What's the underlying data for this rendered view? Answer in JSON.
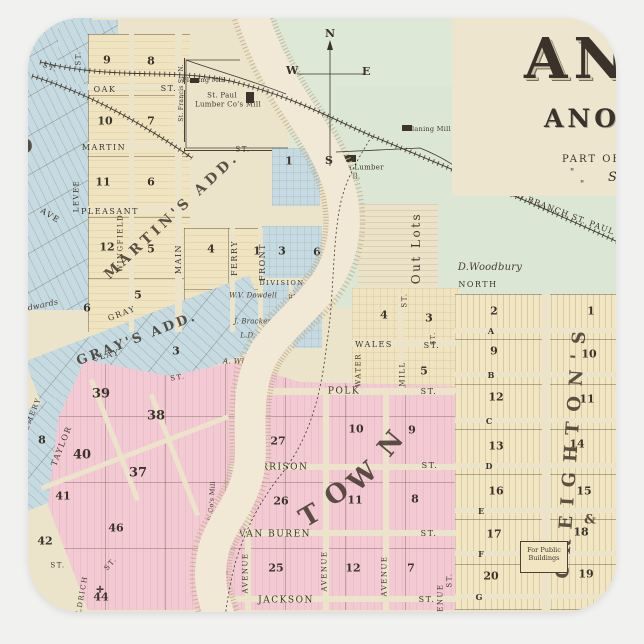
{
  "product": {
    "background_color": "#f1f1f0",
    "sticker_shape": "rounded-square"
  },
  "colors": {
    "paper": "#ece3cb",
    "title_paper": "#eee5cf",
    "green_land": "#dee8d7",
    "blue_blocks": "#c5dae1",
    "yellow_blocks": "#efe4bf",
    "creighton_yellow": "#f1e6c1",
    "pink_blocks": "#f3c9d3",
    "river_water": "#f1e9d6",
    "river_bank": "#c2ae8c",
    "ink": "#3f362b"
  },
  "title": {
    "masthead_partial": "AN",
    "county_line": "ANOKA CO",
    "state_initial": "M",
    "subtitle": "PART OF SEC",
    "ditto_row1": "\" \" \"",
    "ditto_row2": "\" \"",
    "scale_label": "Scale"
  },
  "compass": {
    "n": "N",
    "w": "W",
    "e": "E",
    "s": "S"
  },
  "railroad": {
    "label": "ST. CLOUD BRANCH ST. PAUL &"
  },
  "public_buildings": {
    "line1": "For Public",
    "line2": "Buildings"
  },
  "regions": [
    {
      "name": "open-land-north",
      "x": 268,
      "y": 18,
      "w": 348,
      "h": 132,
      "c": "#dee8d7"
    },
    {
      "name": "open-land-east",
      "x": 336,
      "y": 86,
      "w": 280,
      "h": 222,
      "c": "#dbe6d4"
    },
    {
      "name": "blue-addition-northwest",
      "x": 28,
      "y": 18,
      "w": 64,
      "h": 292,
      "c": "#c5dae1",
      "g": "gdiag"
    },
    {
      "name": "blue-addition-northwest-2",
      "x": 58,
      "y": 20,
      "w": 60,
      "h": 64,
      "c": "#c5dae1",
      "g": "gdiag"
    },
    {
      "name": "martins-add-grid",
      "x": 88,
      "y": 34,
      "w": 102,
      "h": 298,
      "c": "#efe4bf",
      "g": "gym"
    },
    {
      "name": "martins-add-grid-east",
      "x": 184,
      "y": 228,
      "w": 106,
      "h": 104,
      "c": "#efe4bf",
      "g": "gym"
    },
    {
      "name": "lumber-yard",
      "x": 184,
      "y": 58,
      "w": 104,
      "h": 92,
      "c": "#ece3cb",
      "cls": "yard"
    },
    {
      "name": "blue-block-river",
      "x": 272,
      "y": 148,
      "w": 48,
      "h": 58,
      "c": "#c5dae1",
      "g": "ghv"
    },
    {
      "name": "division-st-blocks",
      "x": 262,
      "y": 226,
      "w": 60,
      "h": 122,
      "c": "#c5dae1",
      "g": "ghv"
    },
    {
      "name": "out-lots",
      "x": 358,
      "y": 204,
      "w": 80,
      "h": 98,
      "c": "#ebe2c8",
      "g": "gh"
    },
    {
      "name": "wales-st-blocks",
      "x": 352,
      "y": 288,
      "w": 108,
      "h": 112,
      "c": "#efe4bf",
      "g": "ghv"
    },
    {
      "name": "grays-add-band",
      "x": 30,
      "y": 316,
      "w": 240,
      "h": 72,
      "c": "#c5dae1",
      "g": "gdiag",
      "r": -21,
      "ox": 150,
      "oy": 352
    },
    {
      "name": "grays-add-band-south",
      "x": -5,
      "y": 400,
      "w": 130,
      "h": 95,
      "c": "#c5dae1",
      "g": "gdiag",
      "r": -21,
      "ox": 60,
      "oy": 448
    },
    {
      "name": "creightons-add-grid",
      "x": 455,
      "y": 294,
      "w": 161,
      "h": 316,
      "c": "#f1e6c1",
      "g": "grows"
    },
    {
      "name": "town-pink-area",
      "x": 45,
      "y": 350,
      "w": 412,
      "h": 260,
      "c": "#f3c9d3",
      "g": "gpink",
      "cls": "pink-clip"
    }
  ],
  "street_gaps": [
    {
      "x": 88,
      "y": 84,
      "w": 104,
      "h": 6
    },
    {
      "x": 88,
      "y": 142,
      "w": 104,
      "h": 6
    },
    {
      "x": 88,
      "y": 206,
      "w": 104,
      "h": 6
    },
    {
      "x": 129,
      "y": 34,
      "w": 5,
      "h": 298
    },
    {
      "x": 175,
      "y": 34,
      "w": 7,
      "h": 298
    },
    {
      "x": 230,
      "y": 228,
      "w": 5,
      "h": 104
    },
    {
      "x": 258,
      "y": 228,
      "w": 5,
      "h": 104
    },
    {
      "x": 262,
      "y": 278,
      "w": 60,
      "h": 5
    },
    {
      "x": 289,
      "y": 280,
      "w": 4,
      "h": 68
    },
    {
      "x": 352,
      "y": 340,
      "w": 108,
      "h": 6
    },
    {
      "x": 352,
      "y": 388,
      "w": 108,
      "h": 5
    },
    {
      "x": 398,
      "y": 294,
      "w": 5,
      "h": 46
    },
    {
      "x": 399,
      "y": 346,
      "w": 4,
      "h": 42
    },
    {
      "x": 542,
      "y": 294,
      "w": 8,
      "h": 316
    },
    {
      "x": 455,
      "y": 328,
      "w": 161,
      "h": 5
    },
    {
      "x": 455,
      "y": 372,
      "w": 161,
      "h": 5
    },
    {
      "x": 455,
      "y": 418,
      "w": 161,
      "h": 5
    },
    {
      "x": 455,
      "y": 463,
      "w": 161,
      "h": 5
    },
    {
      "x": 455,
      "y": 508,
      "w": 161,
      "h": 5
    },
    {
      "x": 455,
      "y": 551,
      "w": 161,
      "h": 5
    },
    {
      "x": 455,
      "y": 594,
      "w": 161,
      "h": 5
    },
    {
      "x": 235,
      "y": 388,
      "w": 220,
      "h": 7
    },
    {
      "x": 230,
      "y": 464,
      "w": 226,
      "h": 6
    },
    {
      "x": 230,
      "y": 530,
      "w": 226,
      "h": 6
    },
    {
      "x": 230,
      "y": 596,
      "w": 226,
      "h": 6
    },
    {
      "x": 245,
      "y": 464,
      "w": 6,
      "h": 146
    },
    {
      "x": 323,
      "y": 388,
      "w": 6,
      "h": 222
    },
    {
      "x": 383,
      "y": 388,
      "w": 6,
      "h": 222
    },
    {
      "x": 35,
      "y": 450,
      "w": 200,
      "h": 5,
      "r": -21,
      "ox": 135,
      "oy": 452
    },
    {
      "x": 112,
      "y": 375,
      "w": 5,
      "h": 130,
      "r": -21,
      "ox": 115,
      "oy": 415
    },
    {
      "x": 172,
      "y": 390,
      "w": 5,
      "h": 130,
      "r": -21,
      "ox": 175,
      "oy": 455
    }
  ],
  "map_labels": [
    {
      "t": "OAK",
      "x": 105,
      "y": 90,
      "c": "st"
    },
    {
      "t": "ST.",
      "x": 169,
      "y": 89,
      "c": "st"
    },
    {
      "t": "MARTIN",
      "x": 104,
      "y": 148,
      "c": "st"
    },
    {
      "t": "PLEASANT",
      "x": 110,
      "y": 212,
      "c": "st"
    },
    {
      "t": "GRAY",
      "x": 122,
      "y": 314,
      "r": -21,
      "c": "st"
    },
    {
      "t": "CLAY",
      "x": 106,
      "y": 356,
      "r": -14,
      "c": "st"
    },
    {
      "t": "ST.",
      "x": 178,
      "y": 378,
      "r": -10,
      "c": "st",
      "s": 7
    },
    {
      "t": "DIVISION",
      "x": 282,
      "y": 283,
      "c": "st",
      "s": 6.5
    },
    {
      "t": "ST.",
      "x": 314,
      "y": 284,
      "c": "st",
      "s": 6.5
    },
    {
      "t": "WALES",
      "x": 374,
      "y": 345,
      "c": "st"
    },
    {
      "t": "ST.",
      "x": 432,
      "y": 346,
      "c": "st"
    },
    {
      "t": "POLK",
      "x": 344,
      "y": 392,
      "c": "st",
      "s": 9
    },
    {
      "t": "ST.",
      "x": 429,
      "y": 392,
      "c": "st"
    },
    {
      "t": "HARRISON",
      "x": 276,
      "y": 468,
      "c": "st",
      "s": 9
    },
    {
      "t": "ST.",
      "x": 430,
      "y": 466,
      "c": "st"
    },
    {
      "t": "VAN BUREN",
      "x": 275,
      "y": 535,
      "c": "st",
      "s": 9
    },
    {
      "t": "ST.",
      "x": 429,
      "y": 534,
      "c": "st"
    },
    {
      "t": "JACKSON",
      "x": 286,
      "y": 601,
      "c": "st",
      "s": 9
    },
    {
      "t": "ST.",
      "x": 427,
      "y": 600,
      "c": "st"
    },
    {
      "t": "ST.",
      "x": 58,
      "y": 566,
      "c": "st",
      "s": 7
    },
    {
      "t": "ST.",
      "x": 111,
      "y": 564,
      "r": -50,
      "c": "st",
      "s": 7
    },
    {
      "t": "ST.",
      "x": 243,
      "y": 150,
      "c": "st",
      "s": 7
    },
    {
      "t": "ST.",
      "x": 50,
      "y": 68,
      "r": 22,
      "c": "st",
      "s": 7
    },
    {
      "t": "LEVEE",
      "x": 77,
      "y": 196,
      "r": -90,
      "c": "st",
      "s": 7
    },
    {
      "t": "WINGFIELD",
      "x": 121,
      "y": 243,
      "r": -90,
      "c": "st",
      "s": 7
    },
    {
      "t": "MAIN",
      "x": 179,
      "y": 259,
      "r": -90,
      "c": "st"
    },
    {
      "t": "FERRY",
      "x": 235,
      "y": 258,
      "r": -90,
      "c": "st"
    },
    {
      "t": "FRONT",
      "x": 263,
      "y": 262,
      "r": -90,
      "c": "st"
    },
    {
      "t": "MAPLE",
      "x": 293,
      "y": 311,
      "r": -90,
      "c": "st"
    },
    {
      "t": "St. Francis St. N.",
      "x": 182,
      "y": 93,
      "r": -90,
      "c": "lbl",
      "s": 6
    },
    {
      "t": "ST.",
      "x": 79,
      "y": 58,
      "r": -90,
      "c": "st",
      "s": 7
    },
    {
      "t": "ST.",
      "x": 405,
      "y": 300,
      "r": -90,
      "c": "st",
      "s": 7
    },
    {
      "t": "MILL",
      "x": 403,
      "y": 374,
      "r": -90,
      "c": "st",
      "s": 7
    },
    {
      "t": "WATER",
      "x": 359,
      "y": 370,
      "r": -90,
      "c": "st",
      "s": 7
    },
    {
      "t": "AVENUE",
      "x": 246,
      "y": 573,
      "r": -90,
      "c": "st",
      "s": 7
    },
    {
      "t": "AVENUE",
      "x": 325,
      "y": 571,
      "r": -90,
      "c": "st",
      "s": 7
    },
    {
      "t": "AVENUE",
      "x": 385,
      "y": 576,
      "r": -90,
      "c": "st",
      "s": 7
    },
    {
      "t": "AVENUE",
      "x": 441,
      "y": 604,
      "r": -90,
      "c": "st",
      "s": 7
    },
    {
      "t": "TAYLOR",
      "x": 62,
      "y": 446,
      "r": -68,
      "c": "st"
    },
    {
      "t": "EMERY",
      "x": 33,
      "y": 414,
      "r": -68,
      "c": "st",
      "s": 7
    },
    {
      "t": "ALDRICH",
      "x": 82,
      "y": 598,
      "r": -80,
      "c": "st",
      "s": 7
    },
    {
      "t": "ST.",
      "x": 450,
      "y": 580,
      "r": -90,
      "c": "st",
      "s": 7
    },
    {
      "t": "ST.",
      "x": 434,
      "y": 338,
      "r": -90,
      "c": "st",
      "s": 6
    },
    {
      "t": "AVE",
      "x": 50,
      "y": 216,
      "r": 32,
      "c": "st"
    },
    {
      "t": "A",
      "x": 491,
      "y": 331,
      "c": "num",
      "s": 8
    },
    {
      "t": "B",
      "x": 491,
      "y": 375,
      "c": "num",
      "s": 8
    },
    {
      "t": "C",
      "x": 489,
      "y": 421,
      "c": "num",
      "s": 8
    },
    {
      "t": "D",
      "x": 489,
      "y": 466,
      "c": "num",
      "s": 8
    },
    {
      "t": "E",
      "x": 481,
      "y": 511,
      "c": "num",
      "s": 8
    },
    {
      "t": "F",
      "x": 481,
      "y": 554,
      "c": "num",
      "s": 8
    },
    {
      "t": "G",
      "x": 479,
      "y": 597,
      "c": "num",
      "s": 8
    },
    {
      "t": "9",
      "x": 107,
      "y": 60,
      "c": "num"
    },
    {
      "t": "8",
      "x": 151,
      "y": 61,
      "c": "num"
    },
    {
      "t": "10",
      "x": 105,
      "y": 121,
      "c": "num"
    },
    {
      "t": "7",
      "x": 151,
      "y": 121,
      "c": "num"
    },
    {
      "t": "11",
      "x": 103,
      "y": 182,
      "c": "num"
    },
    {
      "t": "6",
      "x": 151,
      "y": 182,
      "c": "num"
    },
    {
      "t": "12",
      "x": 107,
      "y": 247,
      "c": "num"
    },
    {
      "t": "5",
      "x": 151,
      "y": 249,
      "c": "num"
    },
    {
      "t": "4",
      "x": 211,
      "y": 249,
      "c": "num"
    },
    {
      "t": "1",
      "x": 257,
      "y": 251,
      "c": "num"
    },
    {
      "t": "3",
      "x": 282,
      "y": 251,
      "c": "num"
    },
    {
      "t": "6",
      "x": 317,
      "y": 252,
      "c": "num"
    },
    {
      "t": "4",
      "x": 287,
      "y": 309,
      "c": "num"
    },
    {
      "t": "5",
      "x": 314,
      "y": 307,
      "c": "num"
    },
    {
      "t": "1",
      "x": 289,
      "y": 161,
      "c": "num"
    },
    {
      "t": "4",
      "x": 384,
      "y": 315,
      "c": "num"
    },
    {
      "t": "3",
      "x": 429,
      "y": 318,
      "c": "num"
    },
    {
      "t": "5",
      "x": 424,
      "y": 371,
      "c": "num"
    },
    {
      "t": "2",
      "x": 494,
      "y": 311,
      "c": "num"
    },
    {
      "t": "1",
      "x": 591,
      "y": 311,
      "c": "num"
    },
    {
      "t": "9",
      "x": 494,
      "y": 351,
      "c": "num"
    },
    {
      "t": "10",
      "x": 589,
      "y": 354,
      "c": "num"
    },
    {
      "t": "12",
      "x": 496,
      "y": 397,
      "c": "num"
    },
    {
      "t": "11",
      "x": 587,
      "y": 399,
      "c": "num"
    },
    {
      "t": "13",
      "x": 496,
      "y": 446,
      "c": "num"
    },
    {
      "t": "14",
      "x": 577,
      "y": 444,
      "c": "num"
    },
    {
      "t": "16",
      "x": 496,
      "y": 491,
      "c": "num"
    },
    {
      "t": "15",
      "x": 584,
      "y": 491,
      "c": "num"
    },
    {
      "t": "17",
      "x": 494,
      "y": 534,
      "c": "num"
    },
    {
      "t": "18",
      "x": 581,
      "y": 532,
      "c": "num"
    },
    {
      "t": "20",
      "x": 491,
      "y": 576,
      "c": "num"
    },
    {
      "t": "19",
      "x": 586,
      "y": 574,
      "c": "num"
    },
    {
      "t": "39",
      "x": 101,
      "y": 394,
      "c": "num",
      "s": 13
    },
    {
      "t": "38",
      "x": 156,
      "y": 416,
      "c": "num",
      "s": 13
    },
    {
      "t": "40",
      "x": 82,
      "y": 455,
      "c": "num",
      "s": 13
    },
    {
      "t": "37",
      "x": 138,
      "y": 473,
      "c": "num",
      "s": 13
    },
    {
      "t": "27",
      "x": 278,
      "y": 441,
      "c": "num"
    },
    {
      "t": "10",
      "x": 356,
      "y": 429,
      "c": "num"
    },
    {
      "t": "9",
      "x": 412,
      "y": 430,
      "c": "num"
    },
    {
      "t": "26",
      "x": 281,
      "y": 501,
      "c": "num"
    },
    {
      "t": "11",
      "x": 355,
      "y": 500,
      "c": "num"
    },
    {
      "t": "8",
      "x": 415,
      "y": 499,
      "c": "num"
    },
    {
      "t": "25",
      "x": 276,
      "y": 568,
      "c": "num"
    },
    {
      "t": "12",
      "x": 353,
      "y": 568,
      "c": "num"
    },
    {
      "t": "7",
      "x": 411,
      "y": 568,
      "c": "num"
    },
    {
      "t": "41",
      "x": 63,
      "y": 496,
      "c": "num"
    },
    {
      "t": "42",
      "x": 45,
      "y": 541,
      "c": "num"
    },
    {
      "t": "46",
      "x": 116,
      "y": 528,
      "c": "num"
    },
    {
      "t": "44",
      "x": 101,
      "y": 597,
      "c": "num"
    },
    {
      "t": "5",
      "x": 138,
      "y": 295,
      "c": "num"
    },
    {
      "t": "6",
      "x": 87,
      "y": 308,
      "c": "num"
    },
    {
      "t": "8",
      "x": 42,
      "y": 440,
      "c": "num"
    },
    {
      "t": "3",
      "x": 176,
      "y": 351,
      "c": "num"
    },
    {
      "t": "Planing Mill",
      "x": 204,
      "y": 80,
      "c": "lbl",
      "s": 6.5
    },
    {
      "t": "St. Paul",
      "x": 222,
      "y": 96,
      "c": "lbl"
    },
    {
      "t": "Lumber Co's Mill",
      "x": 228,
      "y": 105,
      "c": "lbl"
    },
    {
      "t": "Planing Mill M. Co.",
      "x": 442,
      "y": 129,
      "c": "lbl",
      "s": 6.5
    },
    {
      "t": "Anoka Lumber",
      "x": 356,
      "y": 168,
      "c": "lbl"
    },
    {
      "t": "Co. Mill.",
      "x": 344,
      "y": 177,
      "c": "lbl"
    },
    {
      "t": "W.D.Washburn & Co's Mill",
      "x": 210,
      "y": 528,
      "r": -86,
      "c": "lbl",
      "s": 6.5
    },
    {
      "t": "Planing Mill",
      "x": 224,
      "y": 575,
      "r": -86,
      "c": "lbl",
      "s": 6.5
    },
    {
      "t": "Out Lots",
      "x": 416,
      "y": 248,
      "r": -90,
      "c": "out"
    },
    {
      "t": "D.Woodbury",
      "x": 490,
      "y": 268,
      "c": "scr",
      "s": 10
    },
    {
      "t": "NORTH",
      "x": 478,
      "y": 285,
      "c": "st",
      "s": 8
    },
    {
      "t": "W.V. Dowdell",
      "x": 253,
      "y": 296,
      "c": "scr",
      "s": 7
    },
    {
      "t": "J. Brackens",
      "x": 255,
      "y": 322,
      "c": "scr",
      "s": 7
    },
    {
      "t": "L.D. White",
      "x": 260,
      "y": 336,
      "c": "scr",
      "s": 7
    },
    {
      "t": "A. Whitten",
      "x": 244,
      "y": 361,
      "c": "scr"
    },
    {
      "t": "Edwards",
      "x": 40,
      "y": 306,
      "r": -12,
      "c": "scr",
      "s": 8
    },
    {
      "t": "MARTIN'S ADD.",
      "x": 172,
      "y": 216,
      "r": -43,
      "c": "big",
      "s": 14,
      "sp": 4
    },
    {
      "t": "GRAY'S ADD.",
      "x": 137,
      "y": 339,
      "r": -21,
      "c": "big",
      "s": 13,
      "sp": 3
    },
    {
      "t": "CREIGHTON'S",
      "x": 572,
      "y": 450,
      "r": -86,
      "c": "big",
      "s": 18,
      "sp": 10
    },
    {
      "t": "&",
      "x": 590,
      "y": 520,
      "c": "big",
      "s": 13
    },
    {
      "t": "T",
      "x": 310,
      "y": 516,
      "r": -30,
      "c": "big",
      "s": 26
    },
    {
      "t": "O",
      "x": 337,
      "y": 494,
      "r": -35,
      "c": "big",
      "s": 26
    },
    {
      "t": "W",
      "x": 363,
      "y": 477,
      "r": -42,
      "c": "big",
      "s": 26
    },
    {
      "t": "N",
      "x": 391,
      "y": 444,
      "r": -50,
      "c": "big",
      "s": 26
    },
    {
      "t": "O",
      "x": 24,
      "y": 146,
      "c": "big",
      "s": 20
    },
    {
      "t": "✛",
      "x": 100,
      "y": 591,
      "c": "num",
      "s": 9
    },
    {
      "t": "ST. CLOUD BRANCH ST. PAUL &",
      "x": 549,
      "y": 208,
      "r": 21,
      "c": "rr"
    }
  ],
  "buildings": [
    {
      "x": 190,
      "y": 78,
      "w": 9,
      "h": 5
    },
    {
      "x": 246,
      "y": 92,
      "w": 8,
      "h": 11
    },
    {
      "x": 336,
      "y": 155,
      "w": 20,
      "h": 7
    },
    {
      "x": 402,
      "y": 125,
      "w": 10,
      "h": 6
    },
    {
      "x": 205,
      "y": 556,
      "w": 7,
      "h": 9
    },
    {
      "x": 250,
      "y": 36,
      "w": 7,
      "h": 6
    }
  ]
}
